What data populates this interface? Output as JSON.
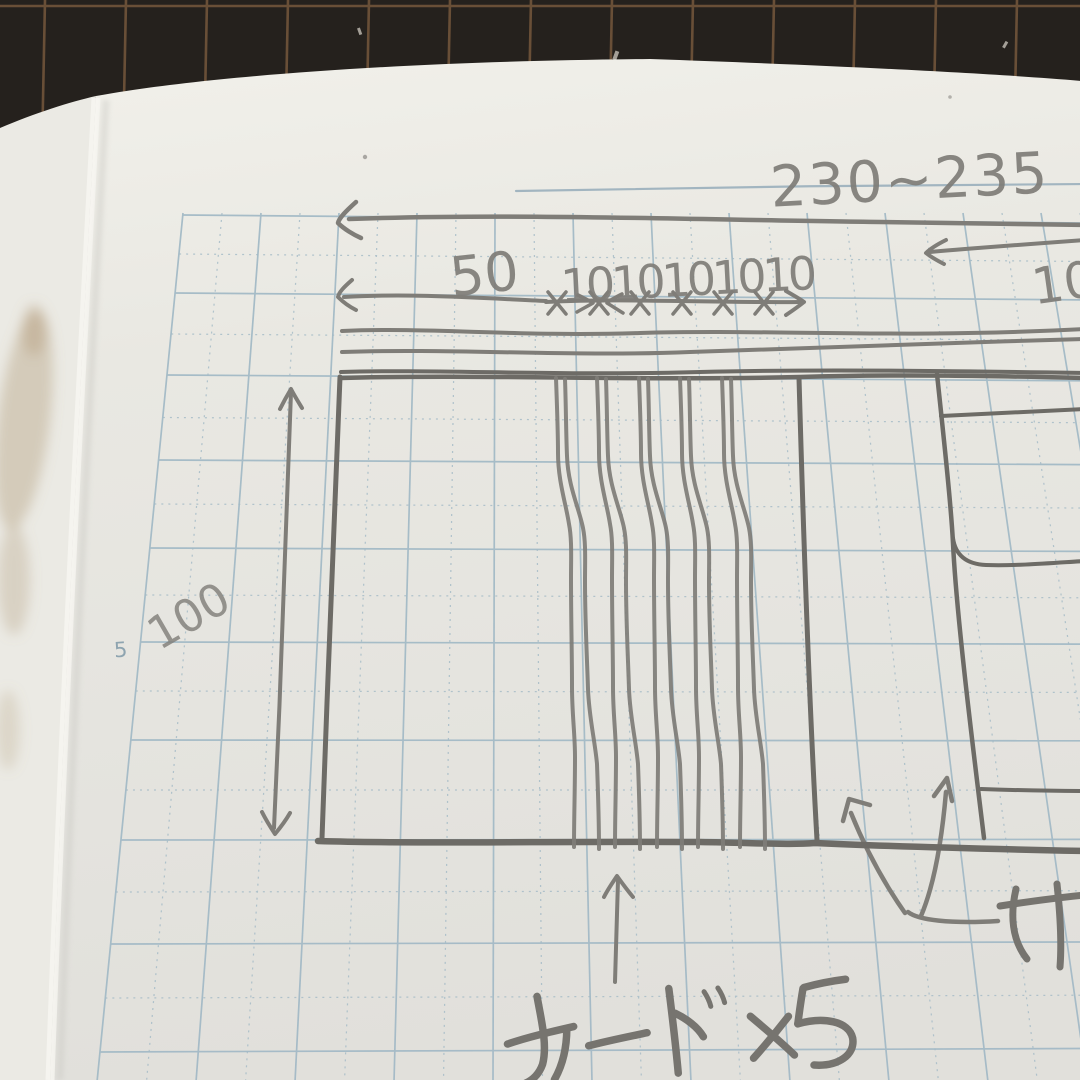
{
  "labels": {
    "total_width": "230~235",
    "left_section": "50",
    "slot_pitch": "1010101010",
    "right_partial": "10",
    "height": "100",
    "cards": "カード×5",
    "clipped_word": "け",
    "margin_number": "5"
  },
  "colors": {
    "mat": "#25211d",
    "mat_grid": "#71543a",
    "paper": "#e8e7e1",
    "grid": "#a3bac6",
    "pencil": "#7f7d78",
    "pencil_dark": "#6d6b66",
    "ink_text": "#76746f",
    "stain": "#a8906a",
    "margin_print": "#8ea4b0"
  }
}
